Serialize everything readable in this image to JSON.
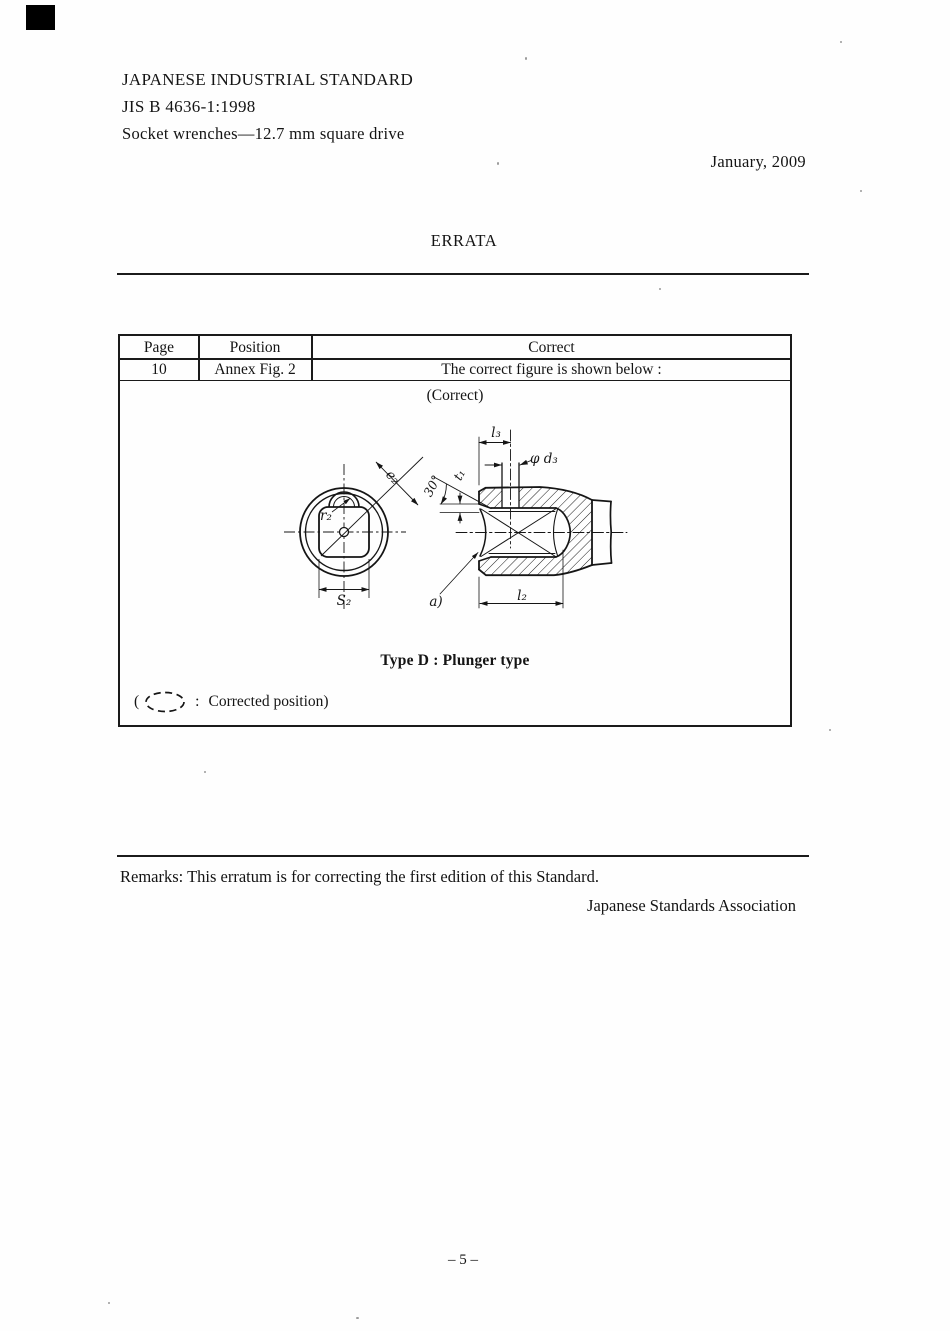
{
  "doc": {
    "standard_name": "JAPANESE INDUSTRIAL STANDARD",
    "standard_number": "JIS B 4636-1:1998",
    "standard_title": "Socket wrenches—12.7 mm square drive",
    "date": "January, 2009",
    "errata_title": "ERRATA",
    "remarks": "Remarks: This erratum is for correcting the first edition of this Standard.",
    "association": "Japanese Standards Association",
    "page_number": "– 5 –"
  },
  "table": {
    "headers": {
      "page": "Page",
      "position": "Position",
      "correct": "Correct"
    },
    "row": {
      "page": "10",
      "position": "Annex Fig. 2",
      "correct": "The correct figure is shown below :"
    },
    "correct_note": "(Correct)",
    "caption": "Type D : Plunger type",
    "legend": {
      "open": "(",
      "sep": ":",
      "text": "Corrected position)"
    }
  },
  "figure": {
    "labels": {
      "l3": "l₃",
      "phi_d3": "φ d₃",
      "angle": "30°",
      "t1": "t₁",
      "e2": "e₂",
      "r2": "r₂",
      "s2": "S₂",
      "a": "a)",
      "l2": "l₂"
    }
  }
}
